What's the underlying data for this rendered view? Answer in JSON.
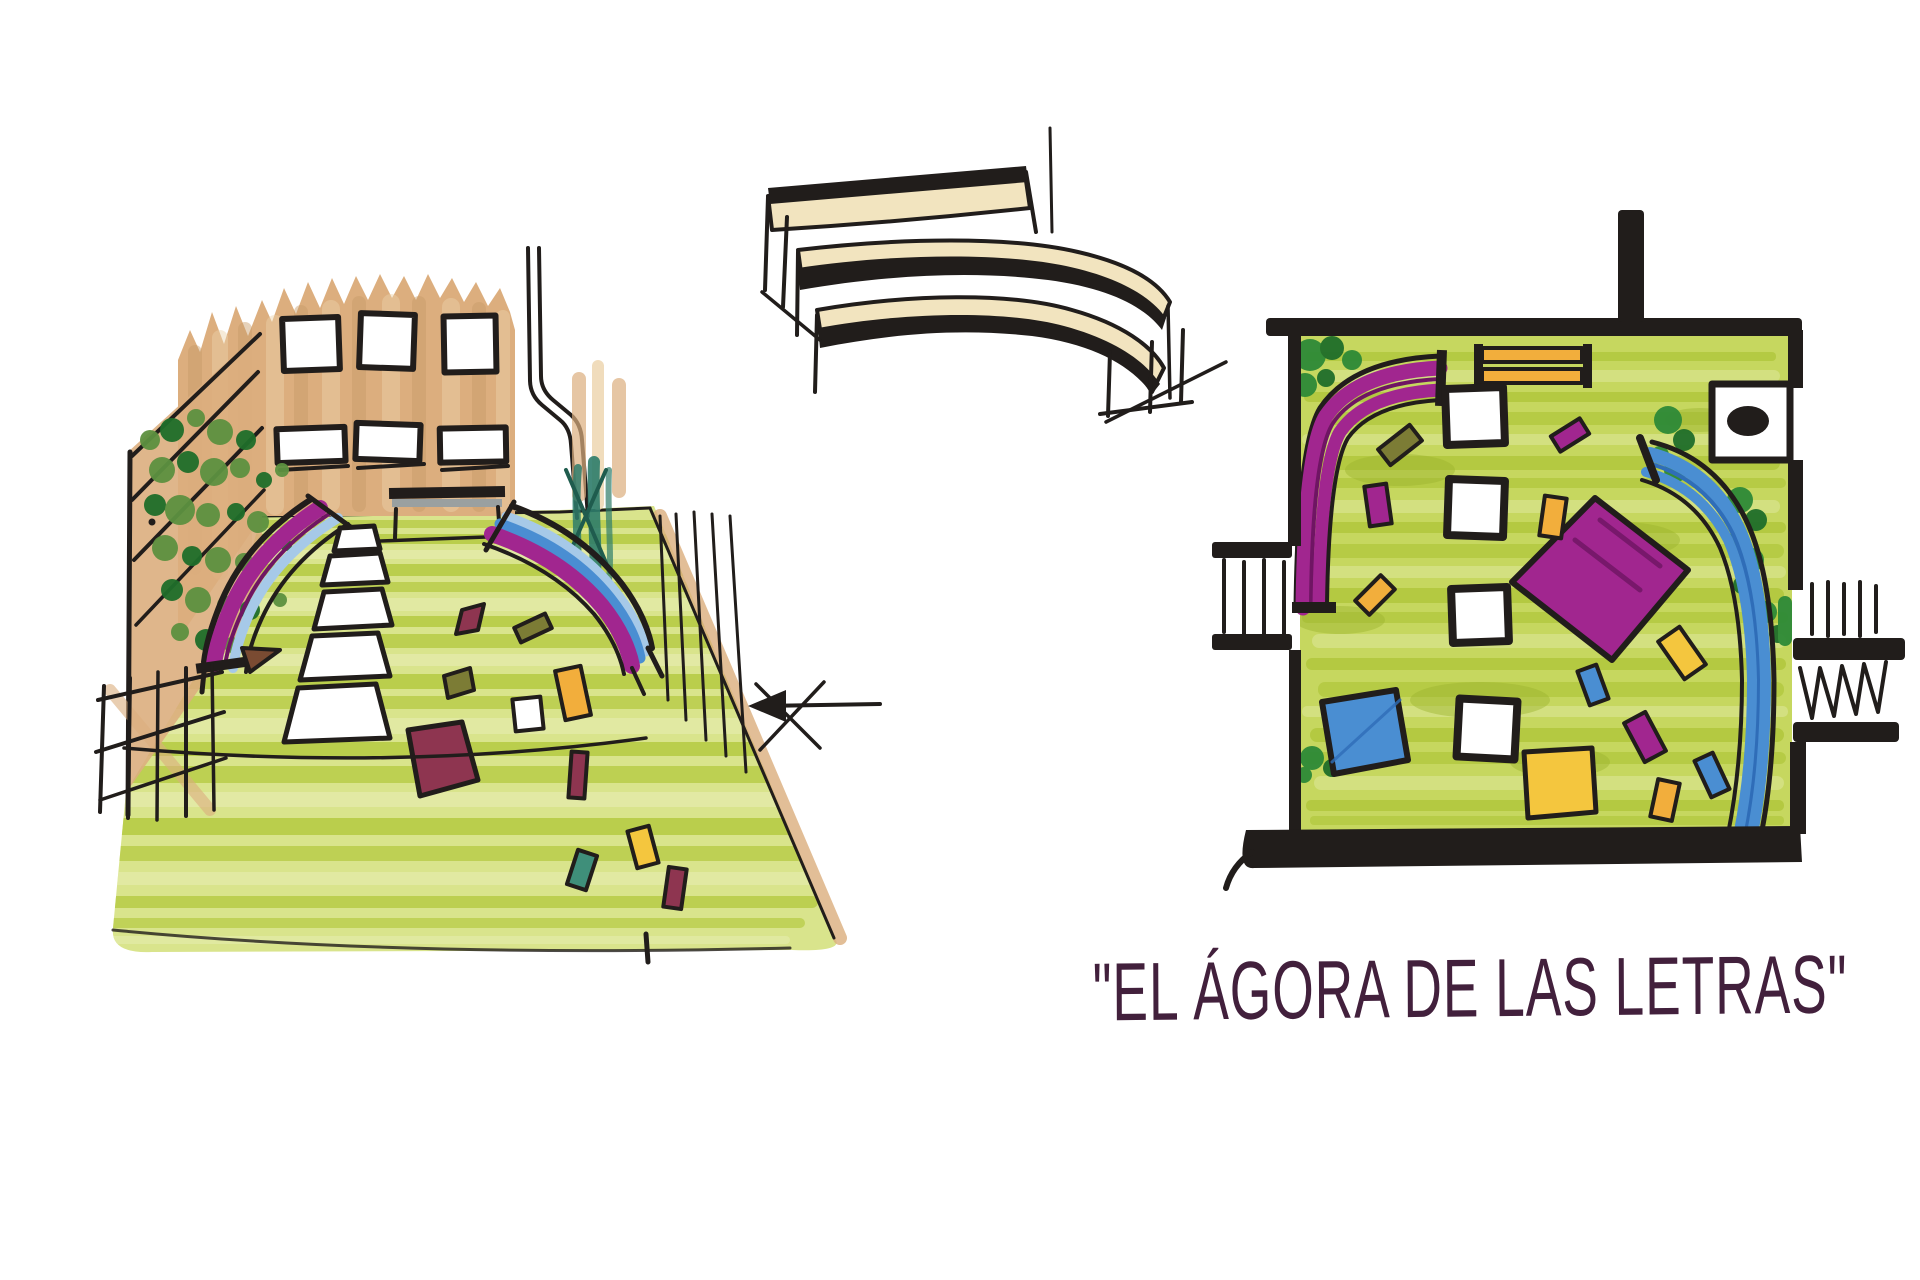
{
  "caption": {
    "text": "\"EL ÁGORA DE LAS LETRAS\""
  },
  "palette": {
    "ink": "#211d1b",
    "caption-plum": "#42203c",
    "paper": "#ffffff",
    "floor-base": "#d9e48c",
    "floor-stripe": "#b2c83c",
    "floor-stripe-light": "#e7edb4",
    "floor-patch": "#9cb42e",
    "plan-floor": "#c6d75f",
    "plan-stripe": "#adc437",
    "plan-stripe-light": "#dfe79a",
    "wall-tan": "#dcae7e",
    "wall-tan-light": "#ecd3ab",
    "wall-tan-dark": "#c89c68",
    "wood-cream": "#f2e4bf",
    "magenta": "#a1268f",
    "magenta-dark": "#6f1563",
    "blue": "#4a8ed2",
    "blue-light": "#a6c9e8",
    "blue-dark": "#2f6db8",
    "orange": "#f2ae3c",
    "yellow": "#f4c63e",
    "bush-green": "#2e8a37",
    "bush-green-dark": "#1f6e2a",
    "ivy-green": "#5d9140",
    "teal": "#2e7d6b",
    "teal-dark": "#1f5c4e",
    "olive": "#7c7c35",
    "brown": "#7a4b32",
    "maroon": "#8e3550",
    "bench-gray": "#9aa0a0"
  }
}
